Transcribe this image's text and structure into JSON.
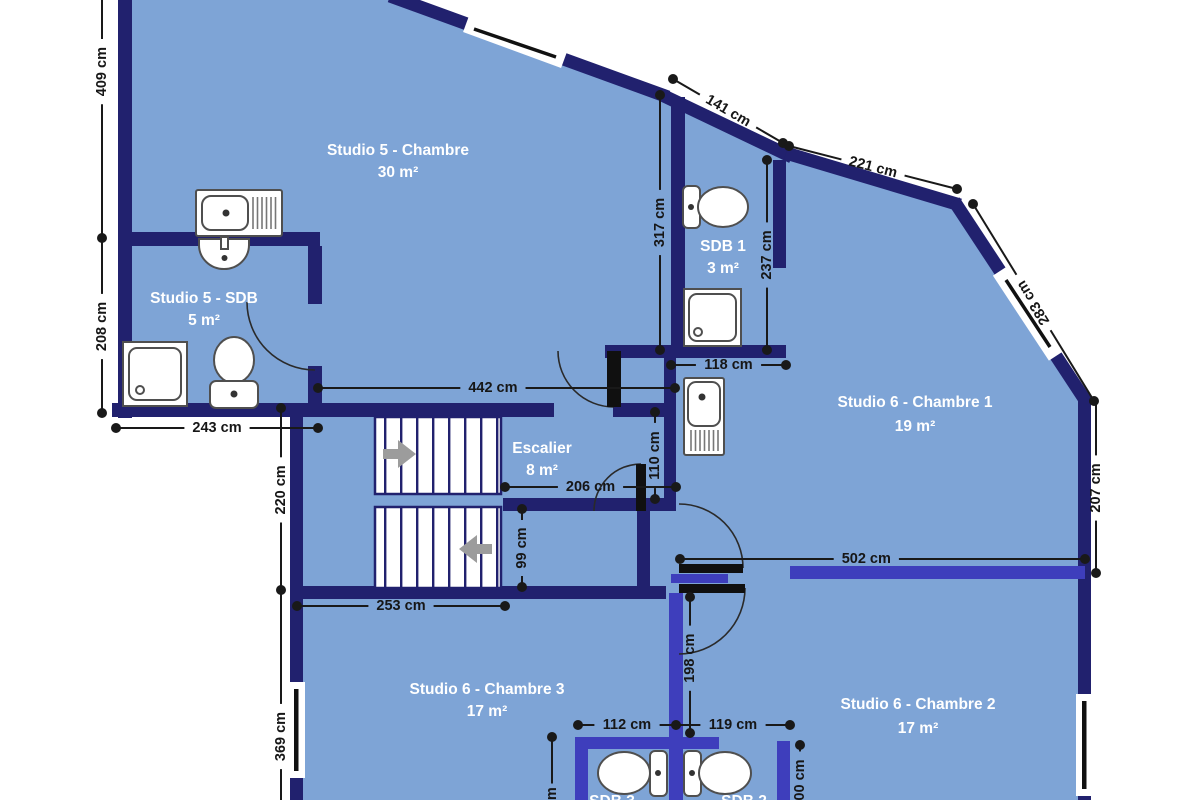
{
  "plan_type": "floor-plan",
  "units": "cm",
  "colors": {
    "floor": "#7ea4d6",
    "wall_outer": "#21216e",
    "wall_inner": "#3e3ebc",
    "dimension": "#191919",
    "room_text": "#ffffff",
    "fixture_stroke": "#4f4f4f",
    "stairs_arrow": "#9c9c9c",
    "door_leaf": "#101010",
    "window_glass": "#111111",
    "background": "#ffffff"
  },
  "rooms": [
    {
      "name": "Studio 5 - Chambre",
      "area": "30 m²"
    },
    {
      "name": "Studio 5 - SDB",
      "area": "5 m²"
    },
    {
      "name": "SDB 1",
      "area": "3 m²"
    },
    {
      "name": "Studio 6 - Chambre 1",
      "area": "19 m²"
    },
    {
      "name": "Escalier",
      "area": "8 m²"
    },
    {
      "name": "Studio 6 - Chambre 3",
      "area": "17 m²"
    },
    {
      "name": "Studio 6 - Chambre 2",
      "area": "17 m²"
    },
    {
      "name": "SDB 3",
      "area": ""
    },
    {
      "name": "SDB 2",
      "area": ""
    }
  ],
  "dimensions": [
    {
      "label": "409 cm",
      "x1": 102,
      "y1": -18,
      "x2": 102,
      "y2": 238,
      "lt": 0.35,
      "dots": [
        0,
        1
      ]
    },
    {
      "label": "208 cm",
      "x1": 102,
      "y1": 240,
      "x2": 102,
      "y2": 413,
      "lt": 0.5,
      "dots": [
        0,
        1
      ]
    },
    {
      "label": "243 cm",
      "x1": 116,
      "y1": 428,
      "x2": 318,
      "y2": 428,
      "lt": 0.5,
      "dots": [
        1,
        1
      ]
    },
    {
      "label": "220 cm",
      "x1": 281,
      "y1": 408,
      "x2": 281,
      "y2": 590,
      "lt": 0.45,
      "dots": [
        1,
        1
      ]
    },
    {
      "label": "369 cm",
      "x1": 281,
      "y1": 590,
      "x2": 281,
      "y2": 812,
      "lt": 0.66,
      "dots": [
        0,
        0
      ]
    },
    {
      "label": "141 cm",
      "x1": 673,
      "y1": 79,
      "x2": 783,
      "y2": 143,
      "lt": 0.5,
      "dots": [
        1,
        1
      ]
    },
    {
      "label": "221 cm",
      "x1": 789,
      "y1": 146,
      "x2": 957,
      "y2": 189,
      "lt": 0.5,
      "dots": [
        1,
        1
      ]
    },
    {
      "label": "283 cm",
      "x1": 973,
      "y1": 204,
      "x2": 1094,
      "y2": 401,
      "lt": 0.5,
      "flip": true,
      "dots": [
        1,
        1
      ]
    },
    {
      "label": "317 cm",
      "x1": 660,
      "y1": 95,
      "x2": 660,
      "y2": 350,
      "lt": 0.5,
      "dots": [
        1,
        1
      ]
    },
    {
      "label": "237 cm",
      "x1": 767,
      "y1": 160,
      "x2": 767,
      "y2": 350,
      "lt": 0.5,
      "dots": [
        1,
        1
      ]
    },
    {
      "label": "118 cm",
      "x1": 671,
      "y1": 365,
      "x2": 786,
      "y2": 365,
      "lt": 0.5,
      "dots": [
        1,
        1
      ]
    },
    {
      "label": "442 cm",
      "x1": 318,
      "y1": 388,
      "x2": 675,
      "y2": 388,
      "lt": 0.49,
      "dots": [
        1,
        1
      ]
    },
    {
      "label": "206 cm",
      "x1": 505,
      "y1": 487,
      "x2": 676,
      "y2": 487,
      "lt": 0.5,
      "dots": [
        1,
        1
      ]
    },
    {
      "label": "110 cm",
      "x1": 655,
      "y1": 412,
      "x2": 655,
      "y2": 499,
      "lt": 0.5,
      "dots": [
        1,
        1
      ]
    },
    {
      "label": "99 cm",
      "x1": 522,
      "y1": 509,
      "x2": 522,
      "y2": 587,
      "lt": 0.5,
      "dots": [
        1,
        1
      ]
    },
    {
      "label": "253 cm",
      "x1": 297,
      "y1": 606,
      "x2": 505,
      "y2": 606,
      "lt": 0.5,
      "dots": [
        1,
        1
      ]
    },
    {
      "label": "502 cm",
      "x1": 680,
      "y1": 559,
      "x2": 1085,
      "y2": 559,
      "lt": 0.46,
      "dots": [
        1,
        1
      ]
    },
    {
      "label": "207 cm",
      "x1": 1096,
      "y1": 403,
      "x2": 1096,
      "y2": 573,
      "lt": 0.5,
      "dots": [
        0,
        1
      ]
    },
    {
      "label": "198 cm",
      "x1": 690,
      "y1": 597,
      "x2": 690,
      "y2": 733,
      "lt": 0.45,
      "dots": [
        1,
        1
      ]
    },
    {
      "label": "112 cm",
      "x1": 578,
      "y1": 725,
      "x2": 676,
      "y2": 725,
      "lt": 0.5,
      "dots": [
        1,
        1
      ]
    },
    {
      "label": "119 cm",
      "x1": 676,
      "y1": 725,
      "x2": 790,
      "y2": 725,
      "lt": 0.5,
      "dots": [
        0,
        1
      ]
    },
    {
      "label": "200 cm",
      "x1": 800,
      "y1": 745,
      "x2": 800,
      "y2": 808,
      "lt": 0.62,
      "dots": [
        1,
        0
      ]
    },
    {
      "label": "cm",
      "x1": 552,
      "y1": 737,
      "x2": 552,
      "y2": 806,
      "lt": 0.88,
      "dots": [
        1,
        0
      ]
    }
  ],
  "icons": {
    "kitchenette": "counter with sink bowl and drainboard hatch",
    "washbasin": "half-round wall basin with faucet",
    "shower": "square tray with inner pan and drain",
    "toilet": "bowl ellipse with cistern",
    "stairs-arrow": "grey direction arrow on stair flight",
    "window": "white band with black glazing bar in wall",
    "door": "black leaf with quarter-circle swing arc"
  }
}
